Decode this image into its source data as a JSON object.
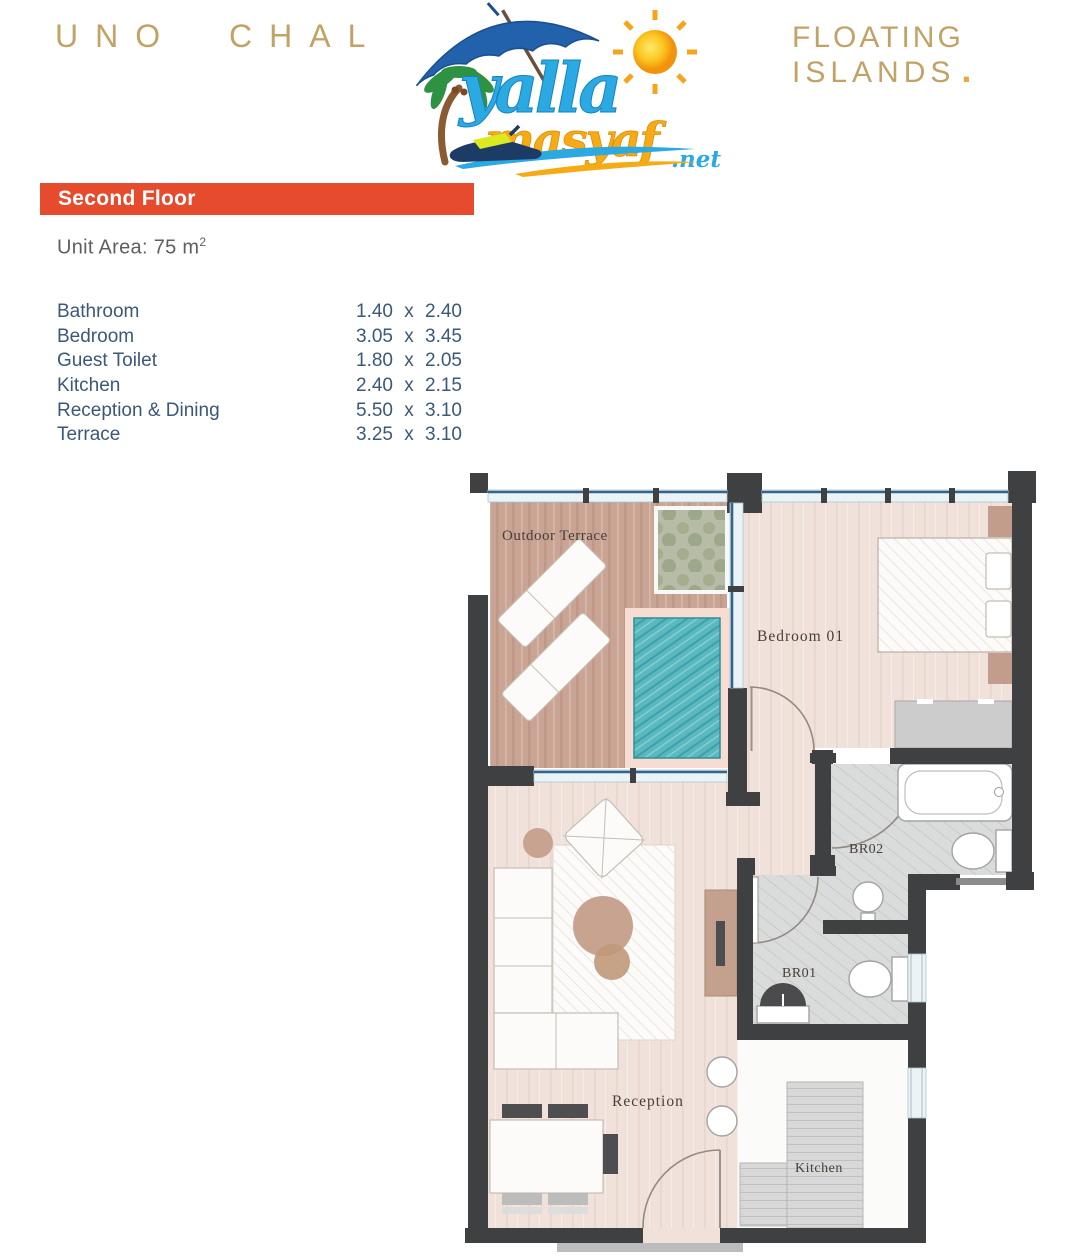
{
  "header": {
    "project_title": "UNO CHAL",
    "brand_line1": "FLOATING",
    "brand_line2": "ISLANDS",
    "brand_dot": ".",
    "logo": {
      "word_top": "yalla",
      "word_bottom": "masyaf",
      "tld": ".net"
    }
  },
  "section": {
    "floor_banner": "Second Floor",
    "unit_area_label": "Unit Area:",
    "unit_area_value": "75 m",
    "unit_area_sup": "2"
  },
  "dimensions": {
    "separator": "x",
    "rows": [
      {
        "room": "Bathroom",
        "w": "1.40",
        "d": "2.40"
      },
      {
        "room": "Bedroom",
        "w": "3.05",
        "d": "3.45"
      },
      {
        "room": "Guest Toilet",
        "w": "1.80",
        "d": "2.05"
      },
      {
        "room": "Kitchen",
        "w": "2.40",
        "d": "2.15"
      },
      {
        "room": "Reception & Dining",
        "w": "5.50",
        "d": "3.10"
      },
      {
        "room": "Terrace",
        "w": "3.25",
        "d": "3.10"
      }
    ]
  },
  "floor_plan": {
    "labels": {
      "outdoor_terrace": "Outdoor Terrace",
      "bedroom_01": "Bedroom 01",
      "br02": "BR02",
      "br01": "BR01",
      "reception": "Reception",
      "kitchen": "Kitchen"
    }
  },
  "colors": {
    "accent": "#e64b2d",
    "gold": "#c3a266",
    "brand_dot": "#efa63c",
    "table_text": "#3b5878",
    "wall": "#3f4042",
    "pool": "#57bac0",
    "logo_blue": "#2aa9e2",
    "logo_yellow": "#f6ab15"
  }
}
